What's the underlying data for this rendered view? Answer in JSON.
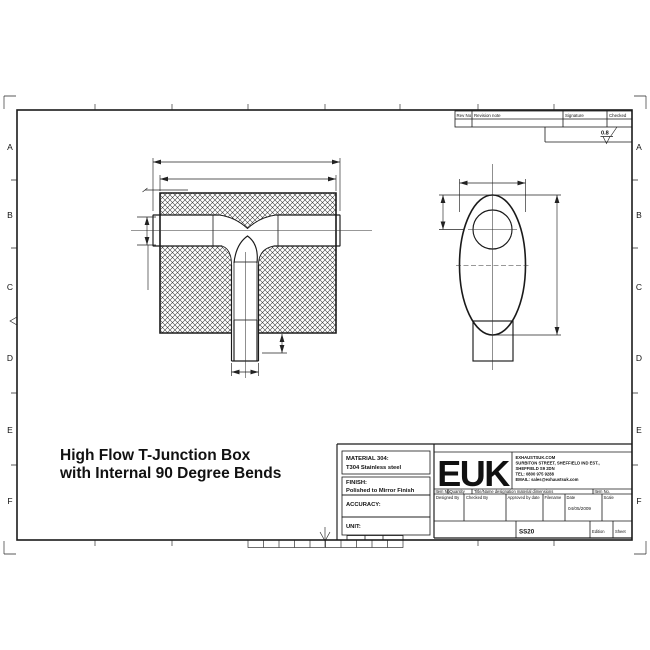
{
  "drawing_title": {
    "line1": "High Flow T-Junction Box",
    "line2": "with Internal 90 Degree Bends"
  },
  "frame": {
    "letters": [
      "A",
      "B",
      "C",
      "D",
      "E",
      "F"
    ]
  },
  "revision_table": {
    "rev_no": "Rev No",
    "revision_note": "Revision note",
    "signature": "Signature",
    "checked": "Checked",
    "surface_finish": "0.8"
  },
  "title_block": {
    "material_label": "MATERIAL 304:",
    "material_value": "T304 Stainless steel",
    "finish_label": "FINISH:",
    "finish_value": "Polished to Mirror Finish",
    "accuracy_label": "ACCURACY:",
    "unit_label": "UNIT:",
    "logo": "EUK",
    "company_line1": "EXHAUSTSUK.COM",
    "company_line2": "SURBITON STREET, SHEFFIELD IND EST.,",
    "company_line3": "SHEFFIELD S9 2DN",
    "company_line4": "TEL: 0800 975 9288",
    "company_line5": "EMAIL: sales@exhaustsuk.com",
    "header_item_no": "Item No",
    "header_quantity": "Quantity",
    "header_title_name": "Title/Name designation material dimensions",
    "header_item_no2": "Item No.",
    "designed_by": "Designed By",
    "checked_by": "Checked By",
    "approved_by": "Approved by date",
    "filename_label": "Filename",
    "date_label": "Date",
    "date_value": "04/05/2009",
    "scale_label": "Scale",
    "part_number": "SS20",
    "edition_label": "Edition",
    "sheet_label": "Sheet"
  }
}
